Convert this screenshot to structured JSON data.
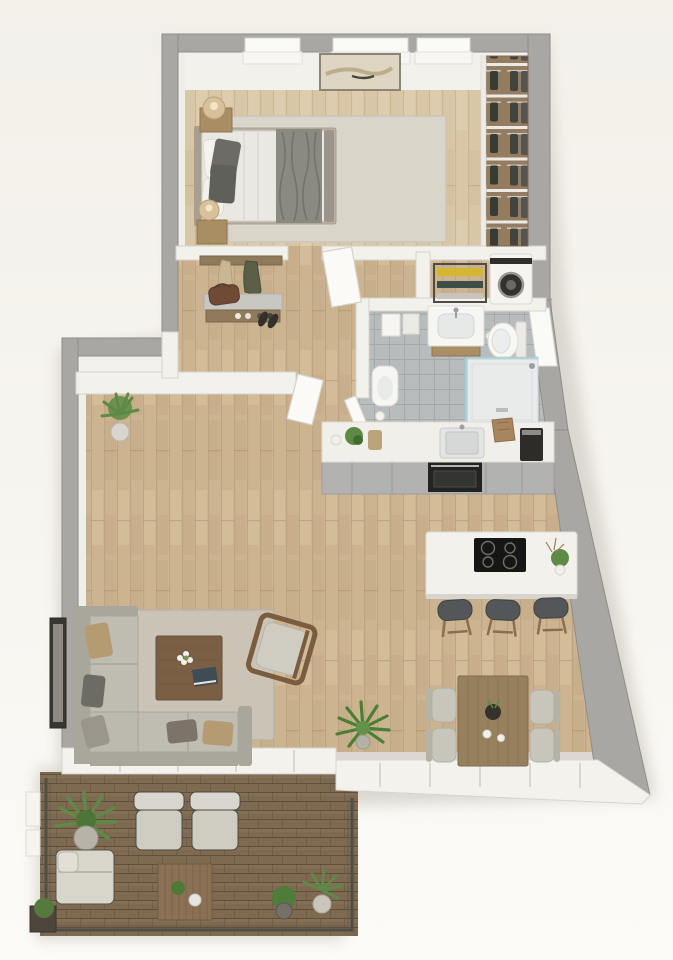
{
  "scene": {
    "title": "One-bedroom apartment with balcony — 3D floor plan, top-down render",
    "type": "3d-floor-plan",
    "view": "top-down",
    "window_openings_bedroom": 3,
    "window_openings_bathroom": 1
  },
  "colors": {
    "background": "#f6f4ee",
    "shadow": "#d7d3ca",
    "wallOuter": "#a9a7a3",
    "wallOuterEdge": "#8f8d88",
    "wallInner": "#f3f1ec",
    "wallInnerEdge": "#d6d3cd",
    "parapet": "#f4f2ed",
    "wood": "#ccb491",
    "woodLight": "#d8c6a6",
    "tile": "#b9bcbd",
    "tileLine": "#a6a9aa",
    "deck": "#7e6951",
    "deckLine": "#5a4936",
    "counter": "#f0efe9",
    "cabinet": "#b2b2b0",
    "appliance": "#232321",
    "island": "#f2f1eb",
    "cooktop": "#161615",
    "sofa": "#bfbcb2",
    "sofaDark": "#a9a69b",
    "rugLiving": "#cbc4b6",
    "rugBedroom": "#dad5c9",
    "duvet": "#eae8e2",
    "pillowDark": "#6c6c65",
    "pillowTan": "#b59b72",
    "throwGray": "#8a8a81",
    "furnWood": "#7b5f44",
    "diningWood": "#96805e",
    "deckTableWood": "#8a7156",
    "chairSeat": "#c8c5bb",
    "stoolSeat": "#53575a",
    "legWood": "#8a6f4e",
    "green": "#5d8a45",
    "greenDark": "#3f6d2e",
    "towelYellow": "#d3b732",
    "towelTeal": "#3d4f47",
    "bagBrown": "#6f4b36",
    "chrome": "#aab0b2",
    "glass": "#a8cdd1",
    "lamp": "#d8c199",
    "closetWood": "#937c5f",
    "clothesDark": "#44443f",
    "frameDark": "#39362f",
    "railing": "#504e48",
    "washerDark": "#2f2e2b"
  },
  "rooms": [
    {
      "id": "bedroom",
      "name": "Bedroom",
      "items": [
        "double bed with gray throw",
        "two dark pillows",
        "two nightstands",
        "two round table lamps",
        "light area rug",
        "abstract wall art",
        "open wardrobe with hanging clothes",
        "three windows"
      ]
    },
    {
      "id": "hallway",
      "name": "Entry hall",
      "items": [
        "wall shelf with two hanging coats",
        "console shoe bench",
        "leather bag",
        "pairs of shoes",
        "open door leaves"
      ]
    },
    {
      "id": "laundry",
      "name": "Laundry nook",
      "items": [
        "washing machine",
        "storage rack with yellow and dark towels"
      ]
    },
    {
      "id": "bathroom",
      "name": "Bathroom",
      "items": [
        "towel rail with towels",
        "vanity washbasin",
        "wall-hung toilet",
        "bidet",
        "toilet paper roll",
        "walk-in shower with glass screen",
        "gray floor tiles",
        "window"
      ]
    },
    {
      "id": "kitchen",
      "name": "Kitchen",
      "items": [
        "counter with inset sink",
        "faucet",
        "paper bag",
        "espresso machine",
        "potted herb",
        "built-in oven",
        "gray cabinet fronts",
        "island with induction cooktop",
        "three bar stools",
        "island plant"
      ]
    },
    {
      "id": "living",
      "name": "Living room",
      "items": [
        "L-shaped sectional sofa",
        "five throw pillows",
        "wooden coffee table",
        "white flowers",
        "book",
        "wooden armchair",
        "area rug",
        "tall framed artwork",
        "potted plant",
        "potted palm"
      ]
    },
    {
      "id": "dining",
      "name": "Dining area",
      "items": [
        "rectangular wooden table",
        "four upholstered chairs",
        "dark centerpiece bowl",
        "two cups"
      ]
    },
    {
      "id": "balcony",
      "name": "Balcony terrace",
      "items": [
        "wooden deck",
        "metal railing",
        "two cushioned lounge chairs",
        "sun lounger",
        "slatted coffee table",
        "large potted plant",
        "two potted plants",
        "white planter boxes",
        "dark corner planter"
      ]
    }
  ]
}
